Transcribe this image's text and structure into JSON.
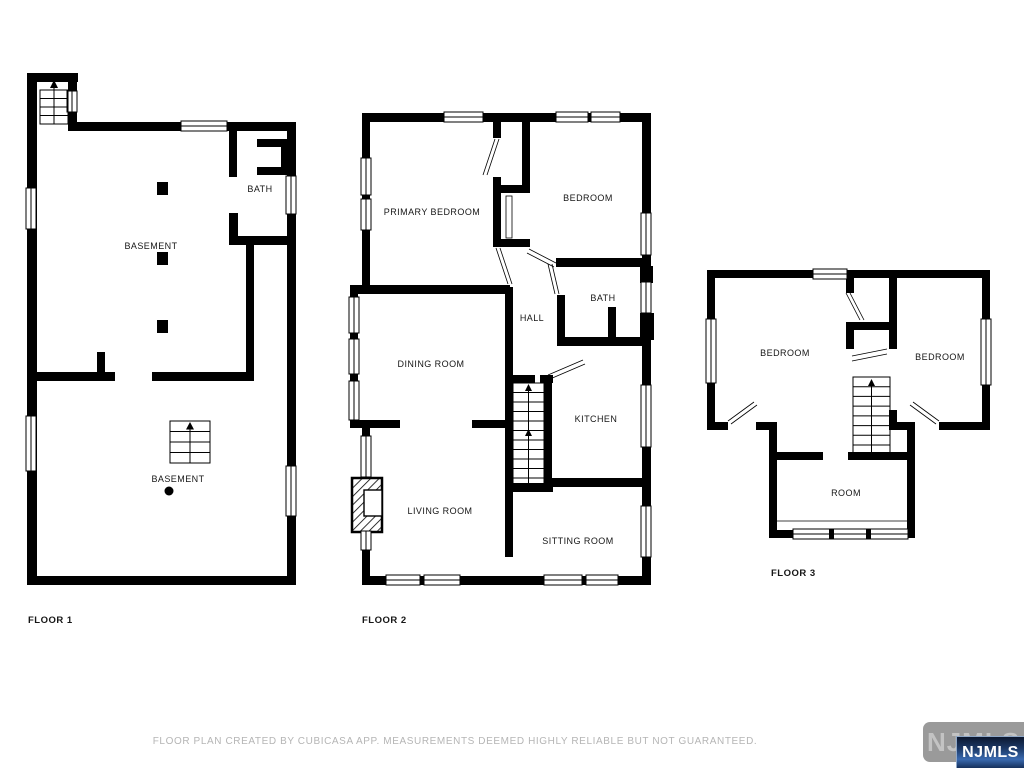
{
  "floors": {
    "floor1": {
      "label": "FLOOR 1",
      "rooms": {
        "basement_upper": "BASEMENT",
        "bath": "BATH",
        "basement_lower": "BASEMENT"
      }
    },
    "floor2": {
      "label": "FLOOR 2",
      "rooms": {
        "primary_bedroom": "PRIMARY BEDROOM",
        "bedroom": "BEDROOM",
        "bath": "BATH",
        "hall": "HALL",
        "dining_room": "DINING ROOM",
        "kitchen": "KITCHEN",
        "living_room": "LIVING ROOM",
        "sitting_room": "SITTING ROOM"
      }
    },
    "floor3": {
      "label": "FLOOR 3",
      "rooms": {
        "bedroom_left": "BEDROOM",
        "bedroom_right": "BEDROOM",
        "room": "ROOM"
      }
    }
  },
  "footer": {
    "disclaimer": "FLOOR PLAN CREATED BY CUBICASA APP. MEASUREMENTS DEEMED HIGHLY RELIABLE BUT NOT GUARANTEED."
  },
  "watermark": {
    "badge_text": "NJMLS",
    "overlay_text": "NJMLS",
    "badge_color": "#9a9a9a",
    "overlay_gradient_top": "#0c1830",
    "overlay_gradient_bottom": "#16305c"
  },
  "colors": {
    "background": "#ffffff",
    "wall": "#000000",
    "label": "#161616",
    "disclaimer": "#b5b5b5"
  }
}
